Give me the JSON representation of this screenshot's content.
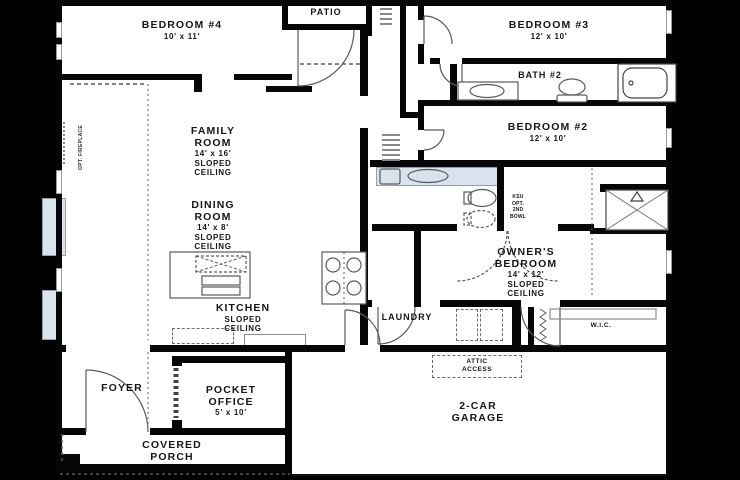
{
  "title": "single-story floor plan",
  "colors": {
    "background": "#000000",
    "paper": "#ffffff",
    "walls": "#060606",
    "label_text": "#161616",
    "accent_blue": "#d9e3ed",
    "fixture_line": "#5a5a5a"
  },
  "rooms": {
    "bedroom4": {
      "name": [
        "BEDROOM #4"
      ],
      "sub": [
        "10' x 11'"
      ]
    },
    "patio": {
      "name": [
        "PATIO"
      ],
      "sub": []
    },
    "bedroom3": {
      "name": [
        "BEDROOM #3"
      ],
      "sub": [
        "12' x 10'"
      ]
    },
    "bath2": {
      "name": [
        "BATH #2"
      ],
      "sub": []
    },
    "bedroom2": {
      "name": [
        "BEDROOM #2"
      ],
      "sub": [
        "12' x 10'"
      ]
    },
    "family": {
      "name": [
        "FAMILY",
        "ROOM"
      ],
      "sub": [
        "14' x 16'",
        "SLOPED",
        "CEILING"
      ]
    },
    "dining": {
      "name": [
        "DINING",
        "ROOM"
      ],
      "sub": [
        "14' x 8'",
        "SLOPED",
        "CEILING"
      ]
    },
    "kitchen": {
      "name": [
        "KITCHEN"
      ],
      "sub": [
        "SLOPED",
        "CEILING"
      ]
    },
    "laundry": {
      "name": [
        "LAUNDRY"
      ],
      "sub": []
    },
    "owners": {
      "name": [
        "OWNER'S",
        "BEDROOM"
      ],
      "sub": [
        "14' x 12'",
        "SLOPED",
        "CEILING"
      ]
    },
    "wic": {
      "name": [
        "W.I.C."
      ],
      "sub": []
    },
    "attic": {
      "name": [
        "ATTIC",
        "ACCESS"
      ],
      "sub": []
    },
    "foyer": {
      "name": [
        "FOYER"
      ],
      "sub": []
    },
    "office": {
      "name": [
        "POCKET",
        "OFFICE"
      ],
      "sub": [
        "5' x 10'"
      ]
    },
    "porch": {
      "name": [
        "COVERED",
        "PORCH"
      ],
      "sub": []
    },
    "garage": {
      "name": [
        "2-CAR",
        "GARAGE"
      ],
      "sub": []
    },
    "opt_fireplace": {
      "name": [
        "OPT. FIREPLACE"
      ],
      "sub": []
    },
    "ksu": {
      "name": [],
      "sub": [
        "KSU",
        "OPT.",
        "2ND",
        "BOWL"
      ]
    }
  },
  "fixtures": [
    "patio-door-swing",
    "front-door-swing",
    "bedroom3-door-swing",
    "bath2-door-swing",
    "bedroom2-door-swing",
    "laundry-door-swing",
    "garage-door-swing",
    "wic-door-swing",
    "owners-bath-double-doors",
    "bath2-vanity-sink",
    "bath2-toilet",
    "bathtub",
    "owners-vanity-sink",
    "owners-toilet",
    "owners-opt-2nd-bowl",
    "shower",
    "kitchen-island-sink",
    "cooktop",
    "washer-dryer",
    "attic-access-panel",
    "wic-rod-and-shelf",
    "linen-shelves",
    "patio-closet-shelves",
    "opt-fireplace-bay",
    "opt-window-bay",
    "covered-porch-step"
  ]
}
